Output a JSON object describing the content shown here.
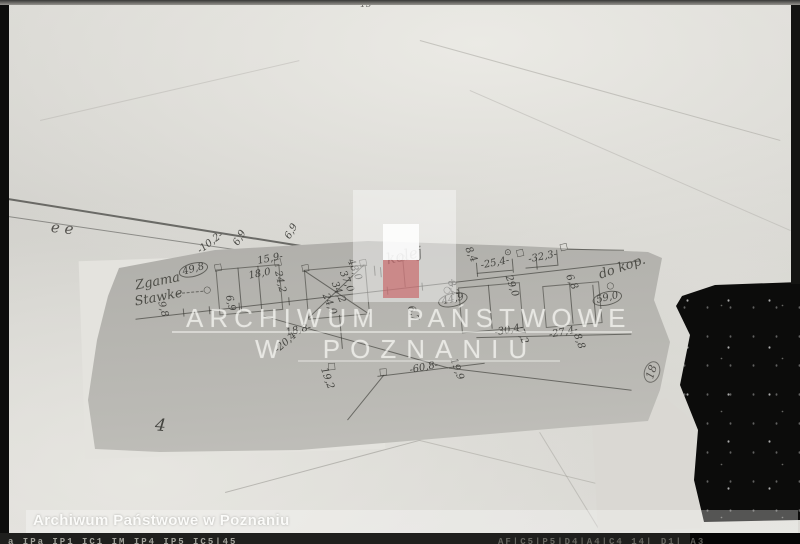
{
  "watermark": {
    "line1": "ARCHIWUM PAŃSTWOWE",
    "line2": "W POZNANIU",
    "logo": {
      "red": "#c7585c",
      "white": "#f6f6f3"
    }
  },
  "caption": {
    "text": "Archiwum Państwowe w Poznaniu"
  },
  "film_strip": {
    "left_codes": "a  IPa  IP1  IC1  IM  IP4 IP5 IC5|45",
    "right_codes": "AF|C5|P5|D4|A4|C4  14|  D1|  A3"
  },
  "marks": {
    "top_pencil": "15·",
    "fold_squiggle": "e e",
    "page_number_circled": "18"
  },
  "sketch": {
    "labels": [
      {
        "t": "Zgama",
        "x": 14,
        "y": 12,
        "r": -6,
        "c": "script"
      },
      {
        "t": "Stawke",
        "x": 12,
        "y": 28,
        "r": -6,
        "c": "script"
      },
      {
        "t": "49,8",
        "x": 58,
        "y": 4,
        "r": -10,
        "circ": 1
      },
      {
        "t": "9,8",
        "x": 44,
        "y": 36,
        "r": 80
      },
      {
        "t": "-10,2-",
        "x": 78,
        "y": -14,
        "r": -32
      },
      {
        "t": "6,9",
        "x": 114,
        "y": -16,
        "r": -55
      },
      {
        "t": "6,9",
        "x": 166,
        "y": -18,
        "r": -55
      },
      {
        "t": "15,9-",
        "x": 138,
        "y": 0,
        "r": -6
      },
      {
        "t": "18,0",
        "x": 128,
        "y": 14,
        "r": -6
      },
      {
        "t": "24,2",
        "x": 163,
        "y": 16,
        "r": 82
      },
      {
        "t": "6,9",
        "x": 112,
        "y": 36,
        "r": 82
      },
      {
        "t": "24,0",
        "x": 208,
        "y": 42,
        "r": 72
      },
      {
        "t": "34,2",
        "x": 218,
        "y": 31,
        "r": 72
      },
      {
        "t": "37,0",
        "x": 227,
        "y": 21,
        "r": 72
      },
      {
        "t": "48,0",
        "x": 236,
        "y": 10,
        "r": 72
      },
      {
        "t": "8,4",
        "x": 354,
        "y": 8,
        "r": 70
      },
      {
        "t": "kolej",
        "x": 266,
        "y": 6,
        "r": -8,
        "c": "script dark"
      },
      {
        "t": "-25,4-",
        "x": 360,
        "y": 24,
        "r": -6
      },
      {
        "t": "-32,3-",
        "x": 408,
        "y": 22,
        "r": -6
      },
      {
        "t": "29,0",
        "x": 392,
        "y": 40,
        "r": 75
      },
      {
        "t": "8,2",
        "x": 334,
        "y": 40,
        "r": 75
      },
      {
        "t": "6,8",
        "x": 452,
        "y": 44,
        "r": 70
      },
      {
        "t": "do kop.",
        "x": 476,
        "y": 42,
        "r": -14,
        "c": "script"
      },
      {
        "t": "59,0",
        "x": 468,
        "y": 68,
        "r": -8,
        "circ": 1
      },
      {
        "t": "44,9",
        "x": 314,
        "y": 56,
        "r": -8,
        "circ": 1
      },
      {
        "t": "6,7",
        "x": 292,
        "y": 62,
        "r": 75
      },
      {
        "t": "18,8-",
        "x": 160,
        "y": 74,
        "r": -8
      },
      {
        "t": "-30,4-",
        "x": 368,
        "y": 92,
        "r": -6
      },
      {
        "t": "7,2",
        "x": 399,
        "y": 94,
        "r": 75
      },
      {
        "t": "-27,4-",
        "x": 422,
        "y": 99,
        "r": -6
      },
      {
        "t": "8,8",
        "x": 455,
        "y": 104,
        "r": 75
      },
      {
        "t": "-60,8-",
        "x": 280,
        "y": 122,
        "r": -6
      },
      {
        "t": "19,9",
        "x": 330,
        "y": 118,
        "r": 75
      },
      {
        "t": "-20,4-",
        "x": 146,
        "y": 92,
        "r": -36
      },
      {
        "t": "19,2",
        "x": 200,
        "y": 116,
        "r": 75
      },
      {
        "t": "4",
        "x": 24,
        "y": 150,
        "r": 10,
        "c": "big"
      }
    ],
    "symbols": [
      {
        "t": "○",
        "x": 82,
        "y": 25,
        "r": 0
      },
      {
        "t": "○",
        "x": 279,
        "y": 10,
        "r": 0
      },
      {
        "t": "⊙",
        "x": 385,
        "y": 14,
        "r": 0
      },
      {
        "t": "○",
        "x": 321,
        "y": 46,
        "r": 0
      },
      {
        "t": "○",
        "x": 484,
        "y": 56,
        "r": 0
      },
      {
        "t": "□",
        "x": 94,
        "y": 4,
        "r": -5
      },
      {
        "t": "□",
        "x": 154,
        "y": 4,
        "r": -5
      },
      {
        "t": "□",
        "x": 181,
        "y": 12,
        "r": -5
      },
      {
        "t": "□",
        "x": 239,
        "y": 12,
        "r": -5
      },
      {
        "t": "□",
        "x": 440,
        "y": 14,
        "r": -8
      },
      {
        "t": "□",
        "x": 396,
        "y": 16,
        "r": -8
      },
      {
        "t": "□",
        "x": 199,
        "y": 112,
        "r": 0
      },
      {
        "t": "□",
        "x": 250,
        "y": 122,
        "r": 0
      }
    ]
  }
}
